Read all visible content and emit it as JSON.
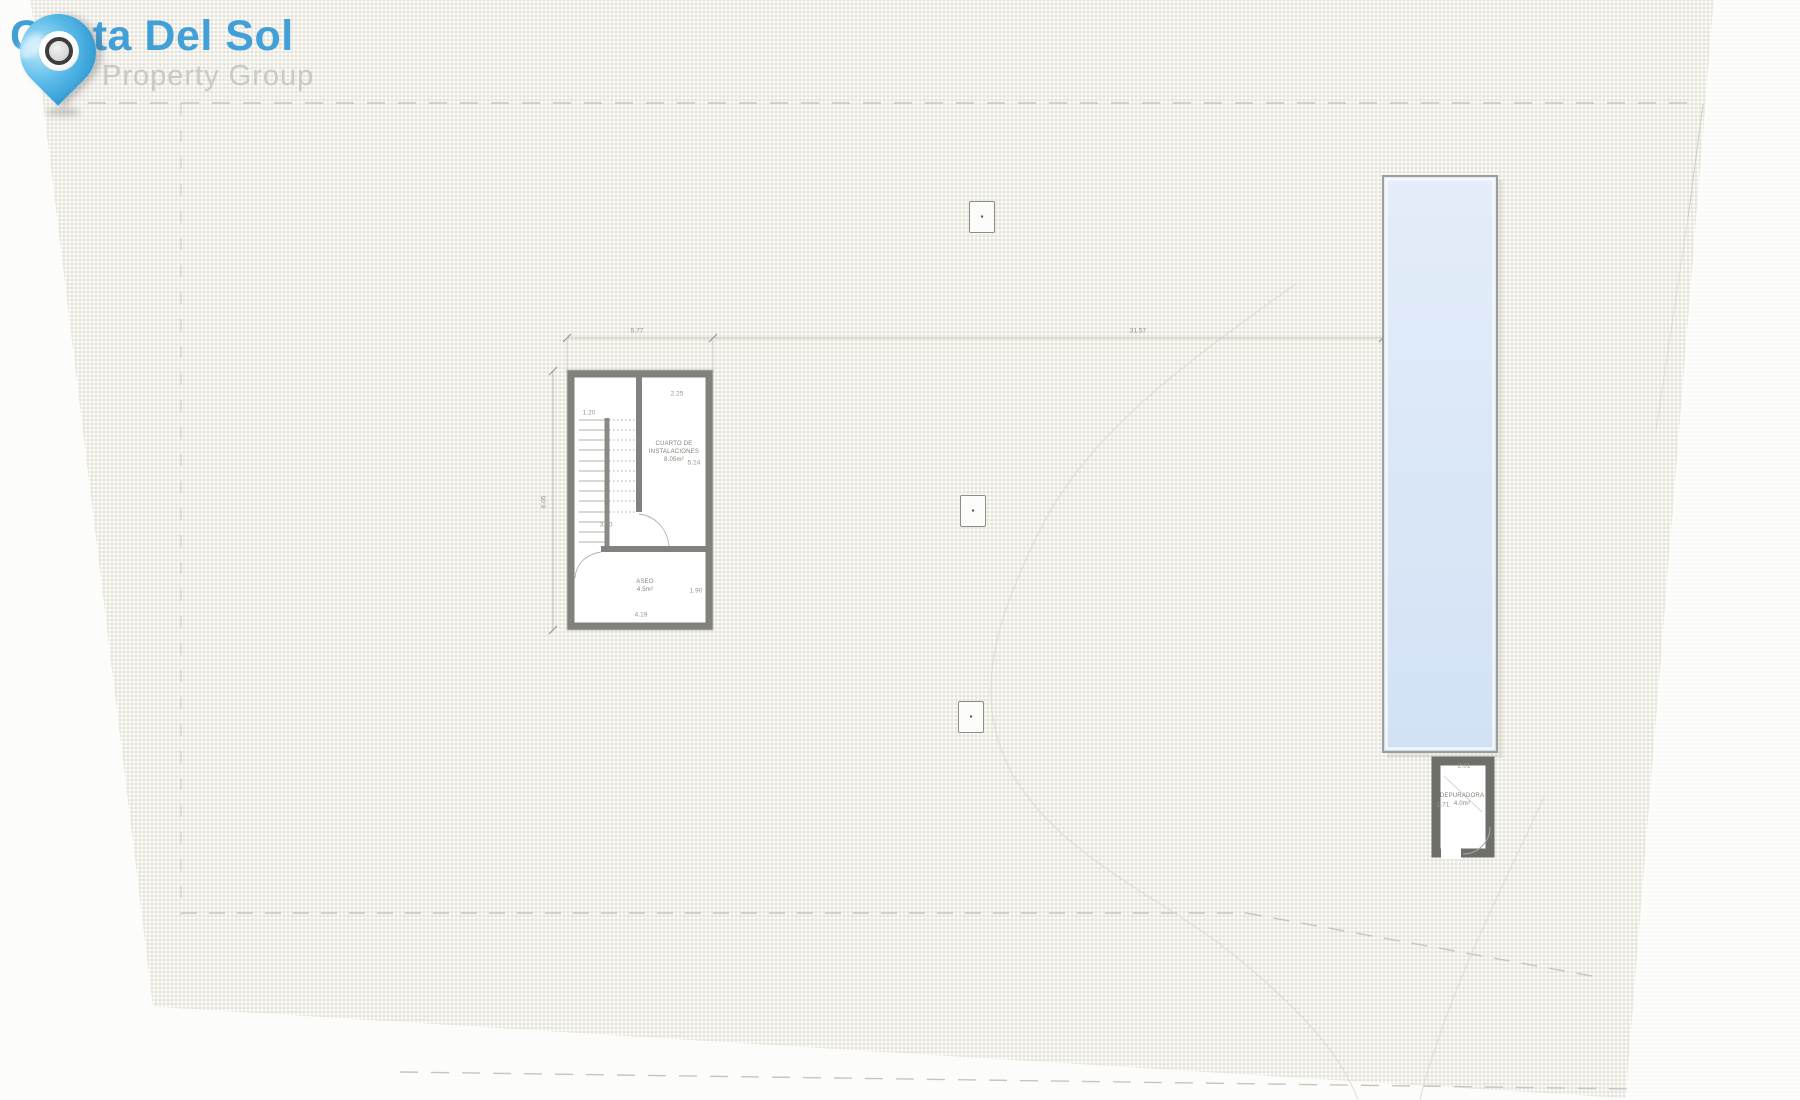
{
  "logo": {
    "title": "Costa Del Sol",
    "subtitle": "Property Group"
  },
  "colors": {
    "brand_blue": "#42a0d8",
    "subtitle_gray": "#c9c9c9",
    "paper_beige": "#f0efe8",
    "wall_gray": "#81817d",
    "pool_fill": "#dbe7f7",
    "dash_gray": "#c7c6be"
  },
  "plan": {
    "dimensions": {
      "building_width": "5.77",
      "building_height": "6.05",
      "building_to_pool": "31.57",
      "stair_width": "1.20",
      "stair_landing": "3.00",
      "room1_width": "2.25",
      "room1_height": "5.24",
      "room2_width": "4.19",
      "room2_height": "1.90",
      "pool_room_width": "2.31",
      "pool_room_height": "1.71"
    },
    "rooms": {
      "installations": {
        "line1": "CUARTO DE",
        "line2": "INSTALACIONES",
        "area": "8.05m²"
      },
      "aseo": {
        "name": "ASEO",
        "area": "4.5m²"
      },
      "pool_room": {
        "name": "DEPURADORA",
        "area": "4.0m²"
      }
    },
    "markers": [
      {
        "glyph": "▪"
      },
      {
        "glyph": "▪"
      },
      {
        "glyph": "▪"
      }
    ]
  }
}
